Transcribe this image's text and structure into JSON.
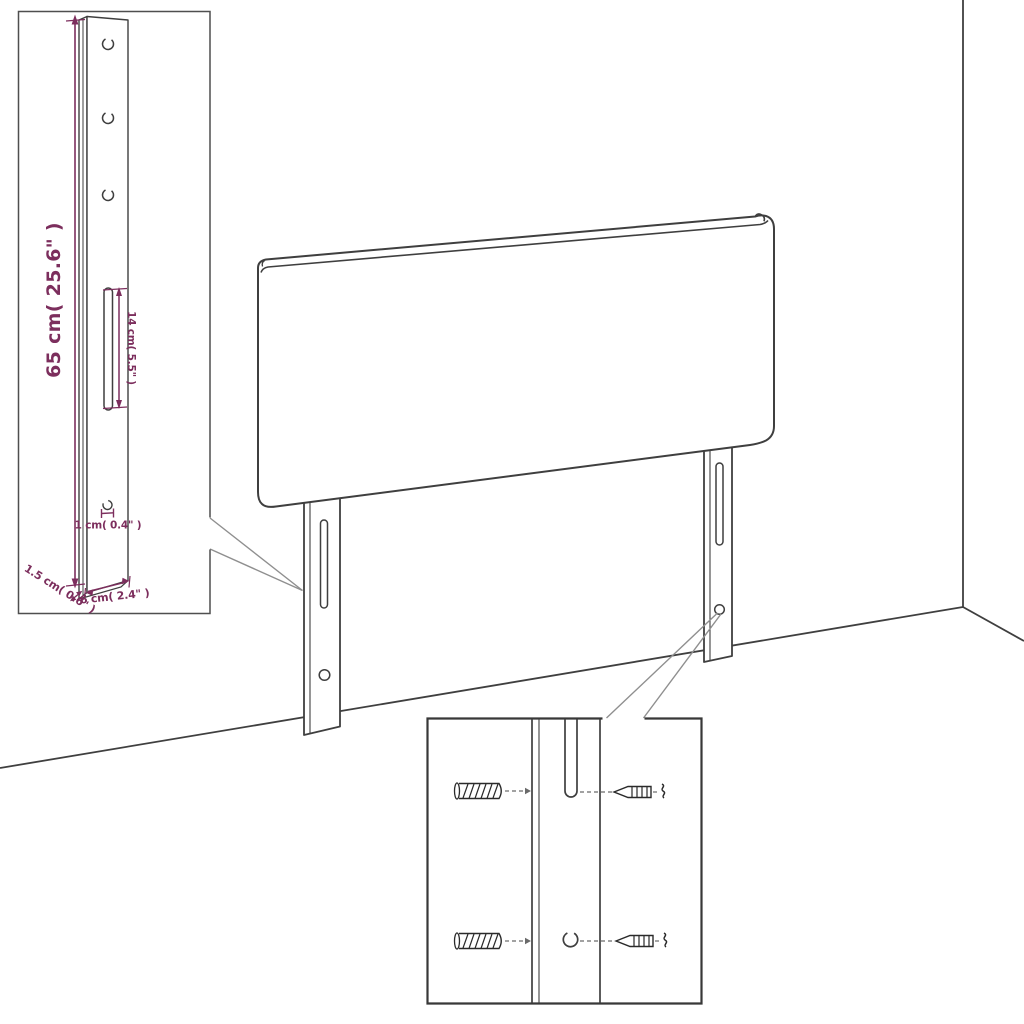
{
  "diagram": {
    "type": "furniture-assembly-dimension-diagram",
    "subject": "upholstered headboard with two slotted mounting legs shown against a room corner",
    "insets": {
      "left": "mounting leg bracket with dimension callouts",
      "bottom": "leg close-up with wall plugs and screws alignment"
    }
  },
  "colors": {
    "line": "#3f3f3f",
    "dimension": "#7c2e5d",
    "callout": "#8f8f8f",
    "inset_border": "#4f4f4f"
  },
  "dimensions": {
    "leg_height": "65 cm( 25.6\" )",
    "slot_length": "14 cm( 5.5\" )",
    "hole_diameter": "1 cm( 0.4\" )",
    "leg_thickness": "1.5 cm( 0.6\" )",
    "leg_width": "6 cm( 2.4\" )"
  },
  "hardware": {
    "wall_plug_count": 2,
    "screw_count": 2
  }
}
